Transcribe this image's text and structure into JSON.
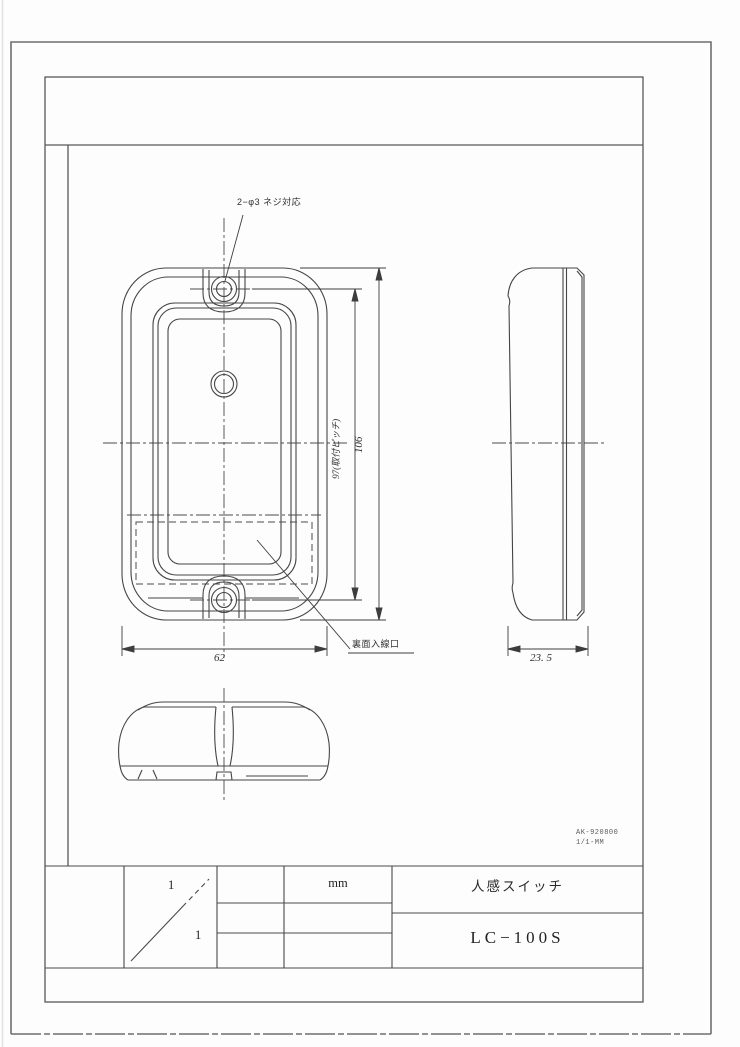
{
  "drawing": {
    "screw_note": "2−φ3 ネジ対応",
    "rear_entry_label": "裏面入線口",
    "dimensions": {
      "mounting_pitch": "97(取付ピッチ)",
      "overall_height": "106",
      "overall_width": "62",
      "depth": "23. 5"
    },
    "doc_notes": {
      "line1": "AK-920800",
      "line2": "1/1-MM"
    }
  },
  "title_block": {
    "scale_numerator": "1",
    "scale_denominator": "1",
    "units": "mm",
    "product_title": "人感スイッチ",
    "model_number": "LC−100S"
  },
  "colors": {
    "line": "#454545",
    "frame": "#6f6f6f",
    "background": "#fdfdfd"
  }
}
